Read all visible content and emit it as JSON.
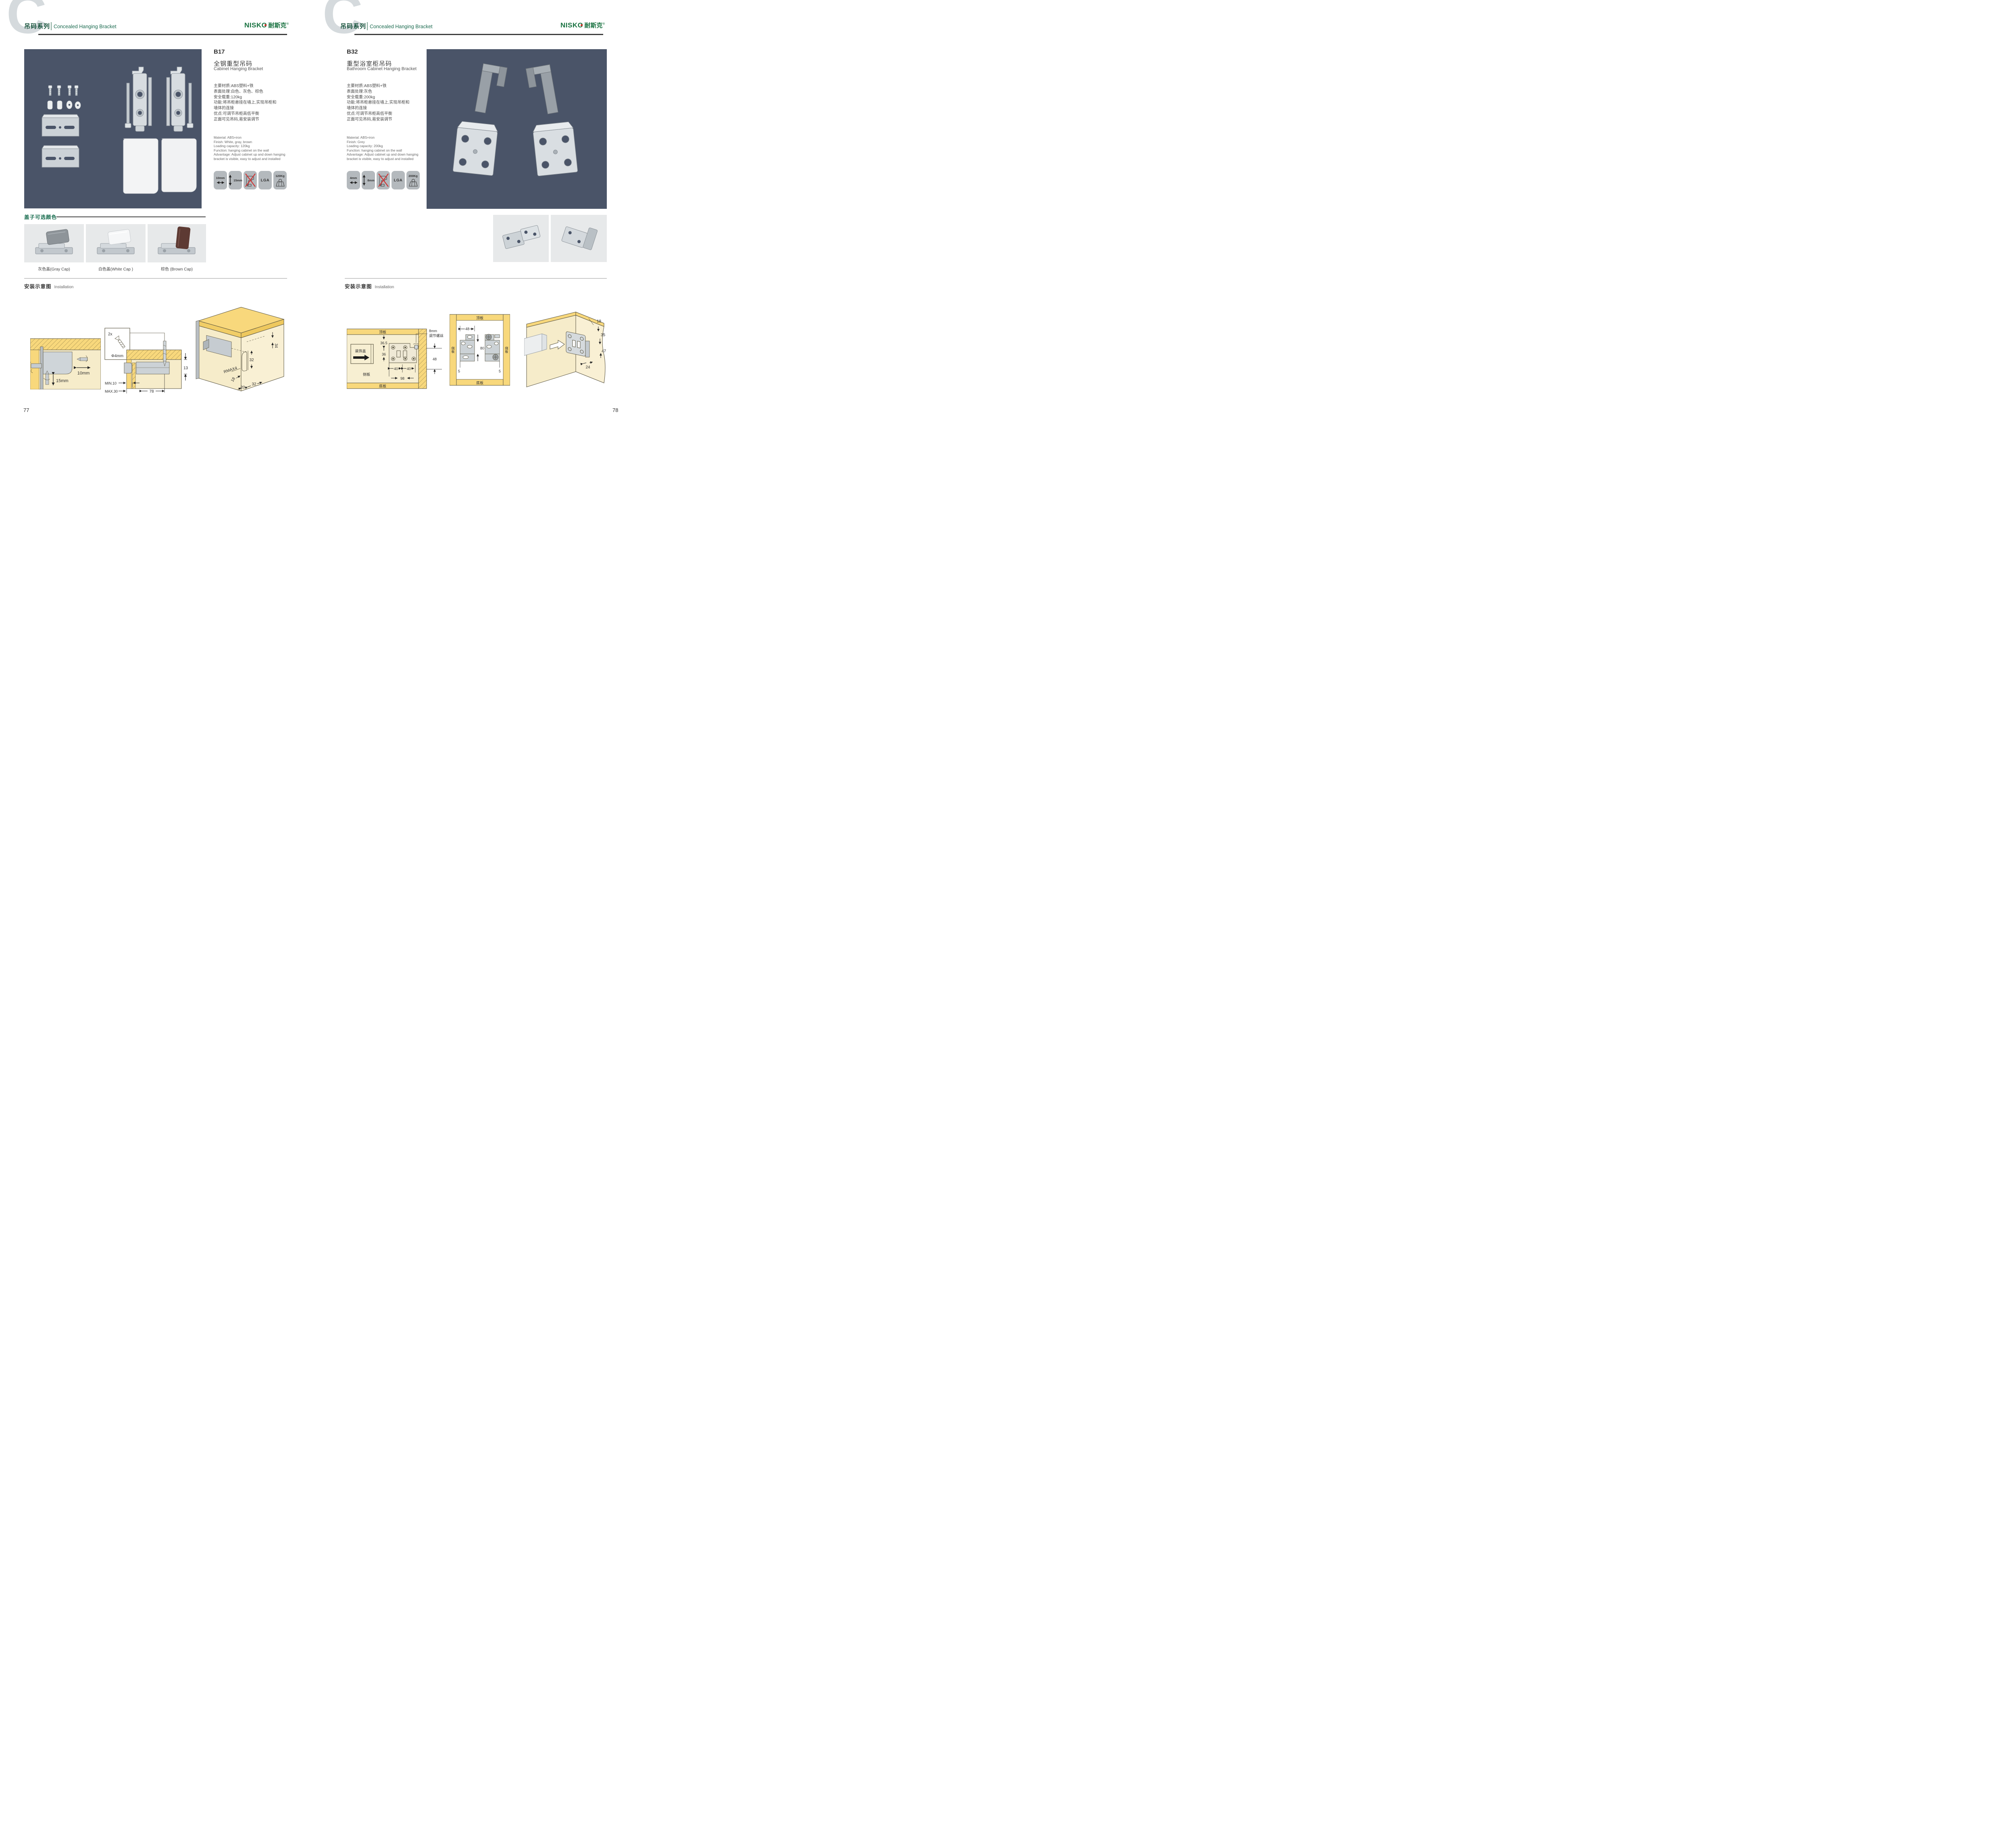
{
  "header": {
    "watermark": "C",
    "series_cn": "吊码系列",
    "series_en": "Concealed Hanging Bracket",
    "logo_en": "NISKO",
    "logo_cn": "耐斯克",
    "logo_reg": "®"
  },
  "left": {
    "page_number": "77",
    "product": {
      "code": "B17",
      "name_cn": "全钢重型吊码",
      "name_en": "Cabinet Hanging Bracket",
      "specs_cn": [
        "主要材质:ABS塑料+铁",
        "表面处理:白色、灰色、棕色",
        "安全载重:120kg",
        "功能:将吊柜悬挂在墙上,实现吊柜和",
        "墙体的连接",
        "优点:可调节吊柜高低平衡",
        "正面可见吊码,易安装调节"
      ],
      "specs_en": [
        "Material: ABS+iron",
        "Finish: White, gray, brown",
        "Loading capacity: 120kg",
        "Function: hanging cabinet on the wall",
        "Advantage: Adjust cabinet up and down hanging",
        "bracket is visible, easy to adjust and installed"
      ],
      "icons": {
        "width": "10mm",
        "height": "15mm",
        "cert": "LGA",
        "load": "120Kg"
      }
    },
    "caps": {
      "title": "盖子可选颜色",
      "labels": [
        "灰色盖(Gray Cap)",
        "白色盖(White Cap )",
        "棕色 (Brown Cap)"
      ]
    },
    "install": {
      "title_cn": "安装示意图",
      "title_en": "Installation",
      "d1": {
        "width": "10mm",
        "height": "15mm"
      },
      "d2": {
        "qty": "2x",
        "dia": "Φ4mm",
        "depth": "13",
        "min": "MIN.10",
        "max": "MAX.30",
        "span": "78"
      },
      "d3": {
        "edge": "34",
        "vert": "32",
        "radius": "RMAX4",
        "a": "18",
        "b": "20",
        "c": "32"
      }
    }
  },
  "right": {
    "page_number": "78",
    "product": {
      "code": "B32",
      "name_cn": "重型浴室柜吊码",
      "name_en": "Bathroom Cabinet Hanging Bracket",
      "specs_cn": [
        "主要材质:ABS塑料+铁",
        "表面处理:灰色",
        "安全载重:200kg",
        "功能:将吊柜悬挂在墙上,实现吊柜和",
        "墙体的连接",
        "优点:可调节吊柜高低平衡",
        "正面可见吊码,易安装调节"
      ],
      "specs_en": [
        "Material: ABS+iron",
        "Finish: Grey",
        "Loading capacity: 200kg",
        "Function: hanging cabinet on the wall",
        "Advantage: Adjust cabinet up and down hanging",
        "bracket is visible, easy to adjust and installed"
      ],
      "icons": {
        "width": "4mm",
        "height": "8mm",
        "cert": "LGA",
        "load": "200Kg"
      }
    },
    "install": {
      "title_cn": "安装示意图",
      "title_en": "Installation",
      "d1": {
        "top": "顶板",
        "bottom": "底板",
        "side": "侧板",
        "cover": "装饰盖",
        "a": "36.5",
        "b": "36",
        "screw_l1": "8mm",
        "screw_l2": "调节螺丝",
        "c": "48",
        "d": "40",
        "e": "40",
        "f": "98"
      },
      "d2": {
        "top": "顶板",
        "bottom": "底板",
        "side_l": "侧板",
        "side_r": "侧板",
        "a": "48",
        "b": "80",
        "c": "5",
        "d": "5"
      },
      "d3": {
        "a": "18",
        "b": "35",
        "c": "47",
        "d": "24"
      }
    }
  }
}
